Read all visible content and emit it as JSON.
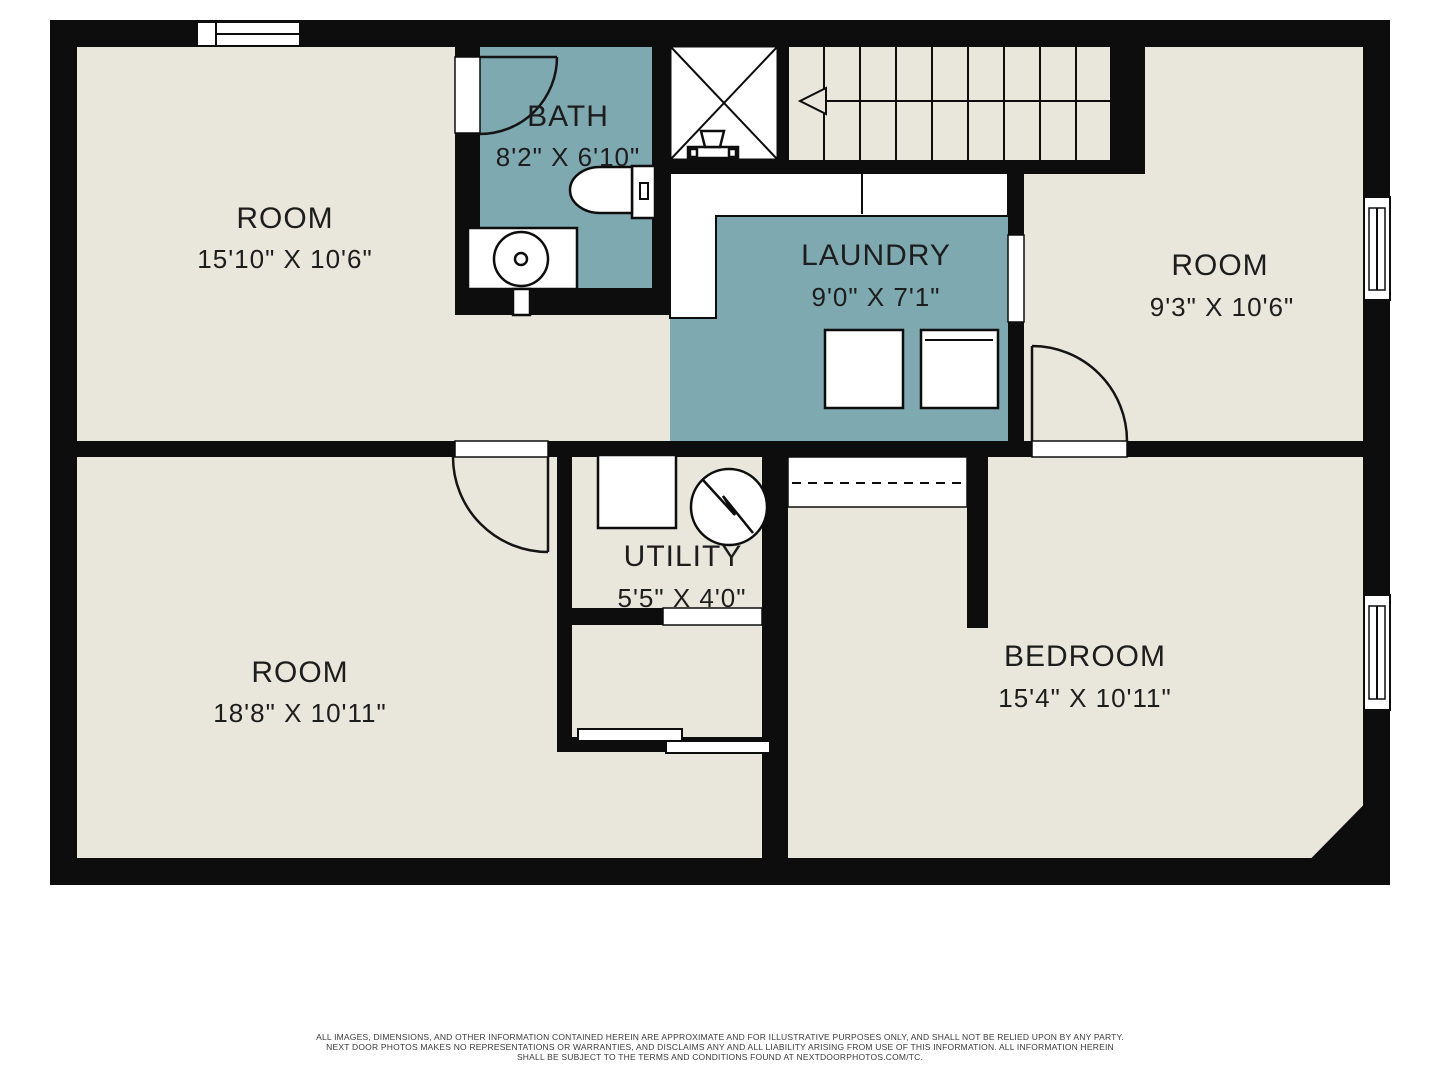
{
  "title": "Basement floor plan",
  "colors": {
    "floor": "#e9e7dc",
    "wet_room": "#7fa9b1",
    "wall": "#0d0d0d",
    "text": "#1d1d1d"
  },
  "rooms": [
    {
      "name": "ROOM",
      "dims": "15'10\" X 10'6\""
    },
    {
      "name": "BATH",
      "dims": "8'2\" X 6'10\""
    },
    {
      "name": "LAUNDRY",
      "dims": "9'0\" X 7'1\""
    },
    {
      "name": "ROOM",
      "dims": "9'3\" X 10'6\""
    },
    {
      "name": "ROOM",
      "dims": "18'8\" X 10'11\""
    },
    {
      "name": "UTILITY",
      "dims": "5'5\" X 4'0\""
    },
    {
      "name": "BEDROOM",
      "dims": "15'4\" X 10'11\""
    }
  ],
  "fixtures": [
    "stairs-up-arrow",
    "shower",
    "toilet",
    "sink-vanity",
    "laundry-counter",
    "washer",
    "dryer",
    "water-heater",
    "furnace",
    "closet-rod",
    "sliding-door",
    "windows"
  ],
  "footer": {
    "line1": "ALL IMAGES, DIMENSIONS, AND OTHER INFORMATION CONTAINED HEREIN ARE APPROXIMATE AND FOR ILLUSTRATIVE PURPOSES ONLY, AND SHALL NOT BE RELIED UPON BY ANY PARTY.",
    "line2": "NEXT DOOR PHOTOS MAKES NO REPRESENTATIONS OR WARRANTIES, AND DISCLAIMS ANY AND ALL LIABILITY ARISING FROM USE OF THIS INFORMATION. ALL INFORMATION HEREIN",
    "line3": "SHALL BE SUBJECT TO THE TERMS AND CONDITIONS FOUND AT NEXTDOORPHOTOS.COM/TC."
  }
}
